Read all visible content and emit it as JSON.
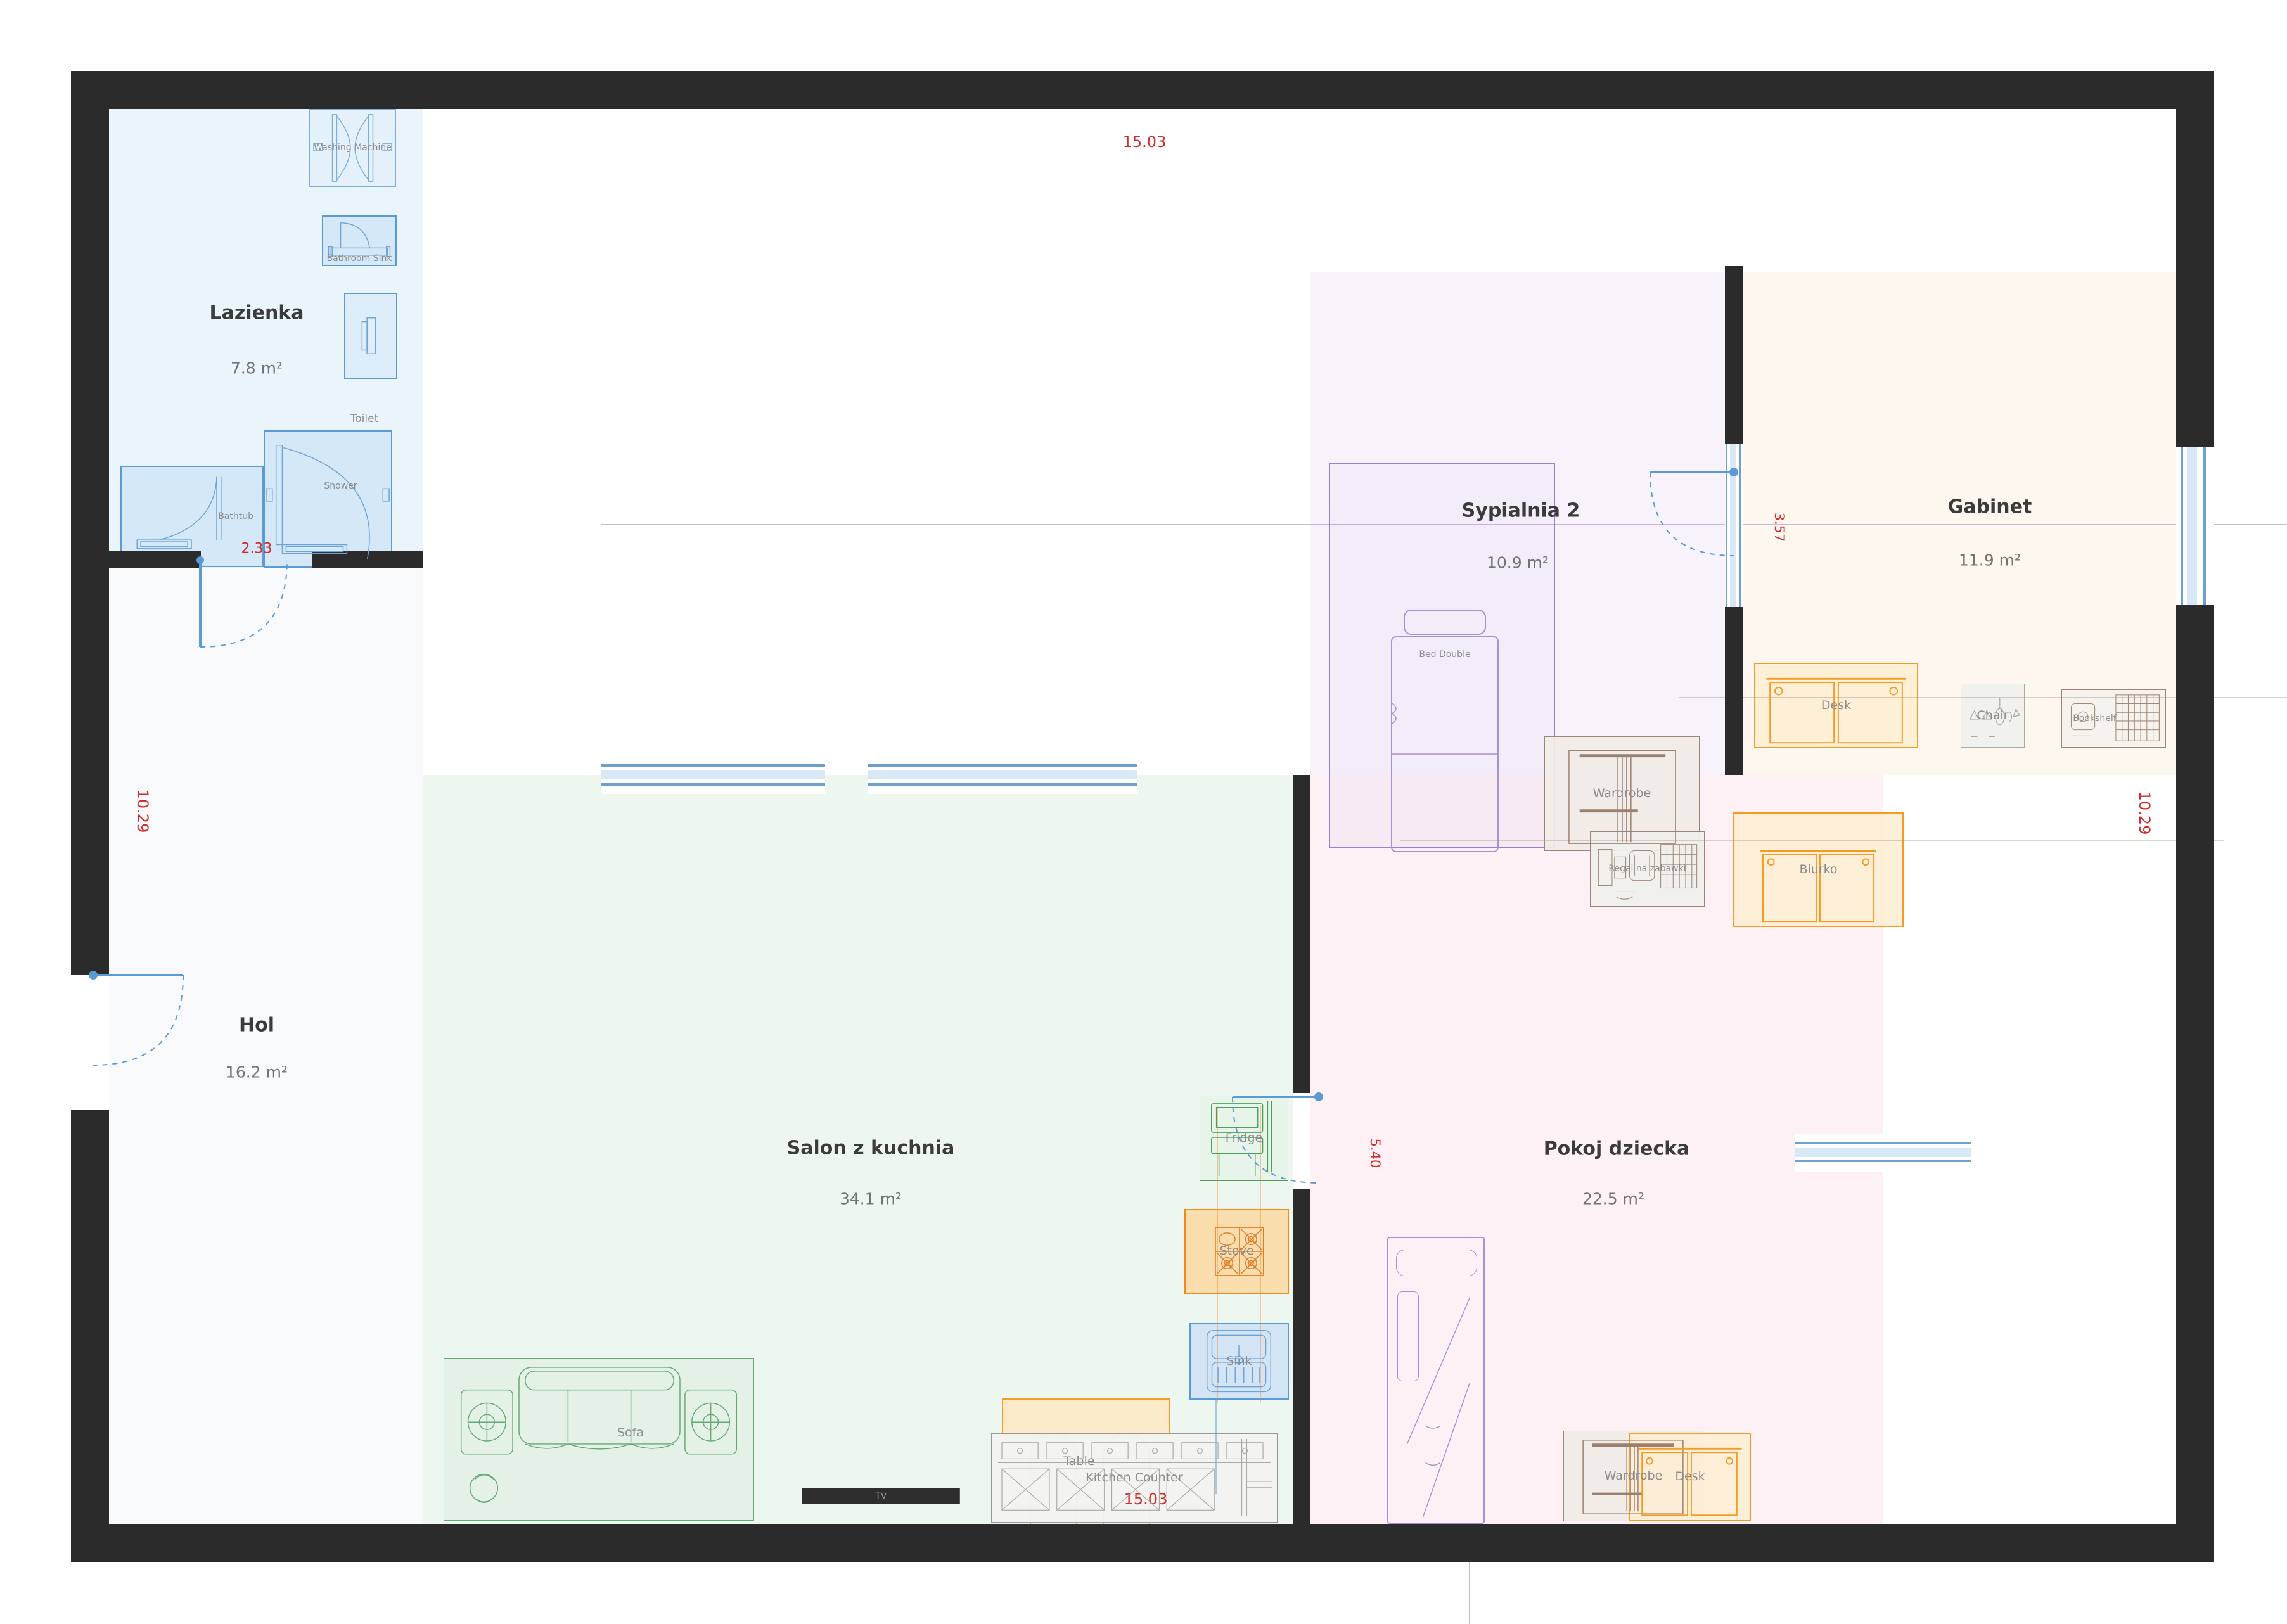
{
  "rooms": [
    {
      "name": "Lazienka",
      "area": "7.8 m²"
    },
    {
      "name": "Hol",
      "area": "16.2 m²"
    },
    {
      "name": "Salon z kuchnia",
      "area": "34.1 m²"
    },
    {
      "name": "Sypialnia 2",
      "area": "10.9 m²"
    },
    {
      "name": "Gabinet",
      "area": "11.9 m²"
    },
    {
      "name": "Pokoj dziecka",
      "area": "22.5 m²"
    }
  ],
  "furniture": {
    "washing_machine": "Washing Machine",
    "bathroom_sink": "Bathroom Sink",
    "toilet": "Toilet",
    "bathtub": "Bathtub",
    "shower": "Shower",
    "sofa": "Sofa",
    "tv": "Tv",
    "fridge": "Fridge",
    "stove": "Stove",
    "sink": "Sink",
    "table": "Table",
    "kitchen_counter": "Kitchen Counter",
    "bed_double": "Bed Double",
    "wardrobe_bedroom": "Wardrobe",
    "wardrobe_kids": "Wardrobe",
    "desk_office": "Desk",
    "desk_kids": "Desk",
    "chair": "Chair",
    "bookshelf": "Bookshelf",
    "toy_shelf": "Regal na zabawki",
    "biurko": "Biurko"
  },
  "dims": {
    "width_top": "15.03",
    "width_bottom": "15.03",
    "height_left": "10.29",
    "height_right": "10.29",
    "bathtub_width": "2.33",
    "bedroom_office": "3.57",
    "kitchen_kids": "5.40"
  },
  "colors": {
    "wall": "#2b2b2b",
    "blue": "#5b9bd5",
    "green": "#67a877",
    "orange": "#ef9430",
    "purple": "#a98fd6",
    "gray": "#9a9a94",
    "brown": "#9a8070",
    "red": "#cf2d2d"
  }
}
